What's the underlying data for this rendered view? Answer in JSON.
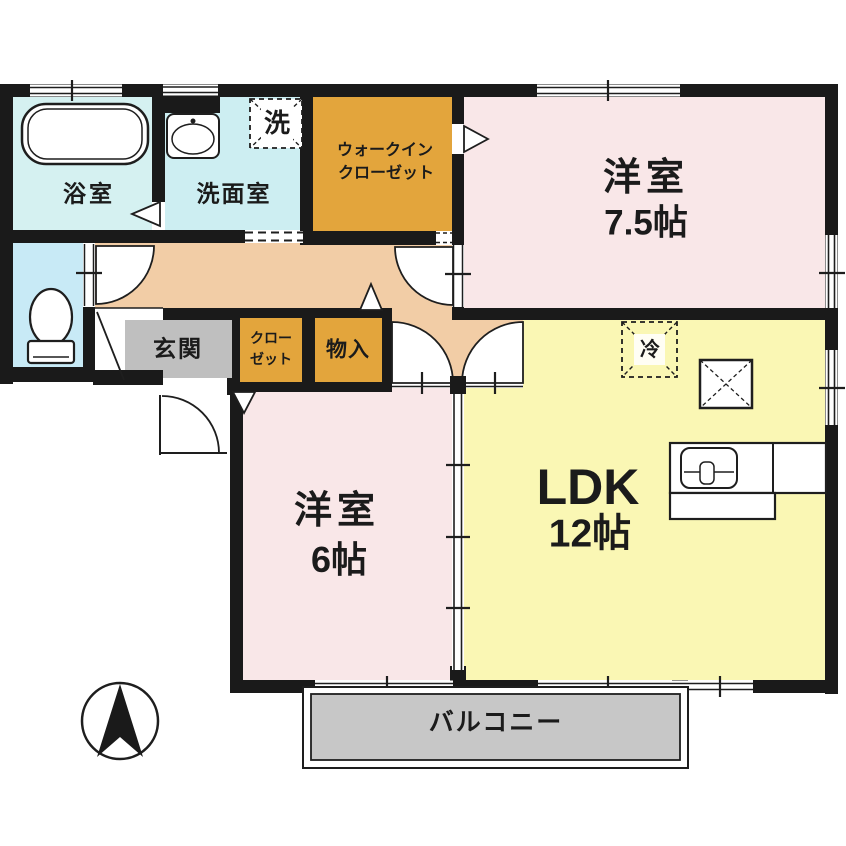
{
  "title": "2LDK apartment floor plan",
  "colors": {
    "wall": "#1a1a1a",
    "pink": "#f9e7e8",
    "yellow": "#faf7b4",
    "peach": "#f2cda6",
    "orange": "#e3a53c",
    "bath": "#d5f1f1",
    "wash": "#cdeef2",
    "toilet": "#c8eaf6",
    "genkan": "#bfbfbf",
    "balcony": "#c7c7c7",
    "line": "#1e1e1e"
  },
  "rooms": {
    "bathroom": {
      "label": "浴室"
    },
    "washroom": {
      "label": "洗面室"
    },
    "laundry": {
      "label": "洗"
    },
    "walk_in_closet": {
      "line1": "ウォークイン",
      "line2": "クローゼット"
    },
    "bedroom1": {
      "label": "洋室",
      "size": "7.5帖"
    },
    "entrance": {
      "label": "玄関"
    },
    "closet": {
      "line1": "クロー",
      "line2": "ゼット"
    },
    "storage": {
      "label": "物入"
    },
    "bedroom2": {
      "label": "洋室",
      "size": "6帖"
    },
    "ldk": {
      "label": "LDK",
      "size": "12帖"
    },
    "refrigerator": {
      "label": "冷"
    },
    "balcony": {
      "label": "バルコニー"
    }
  }
}
